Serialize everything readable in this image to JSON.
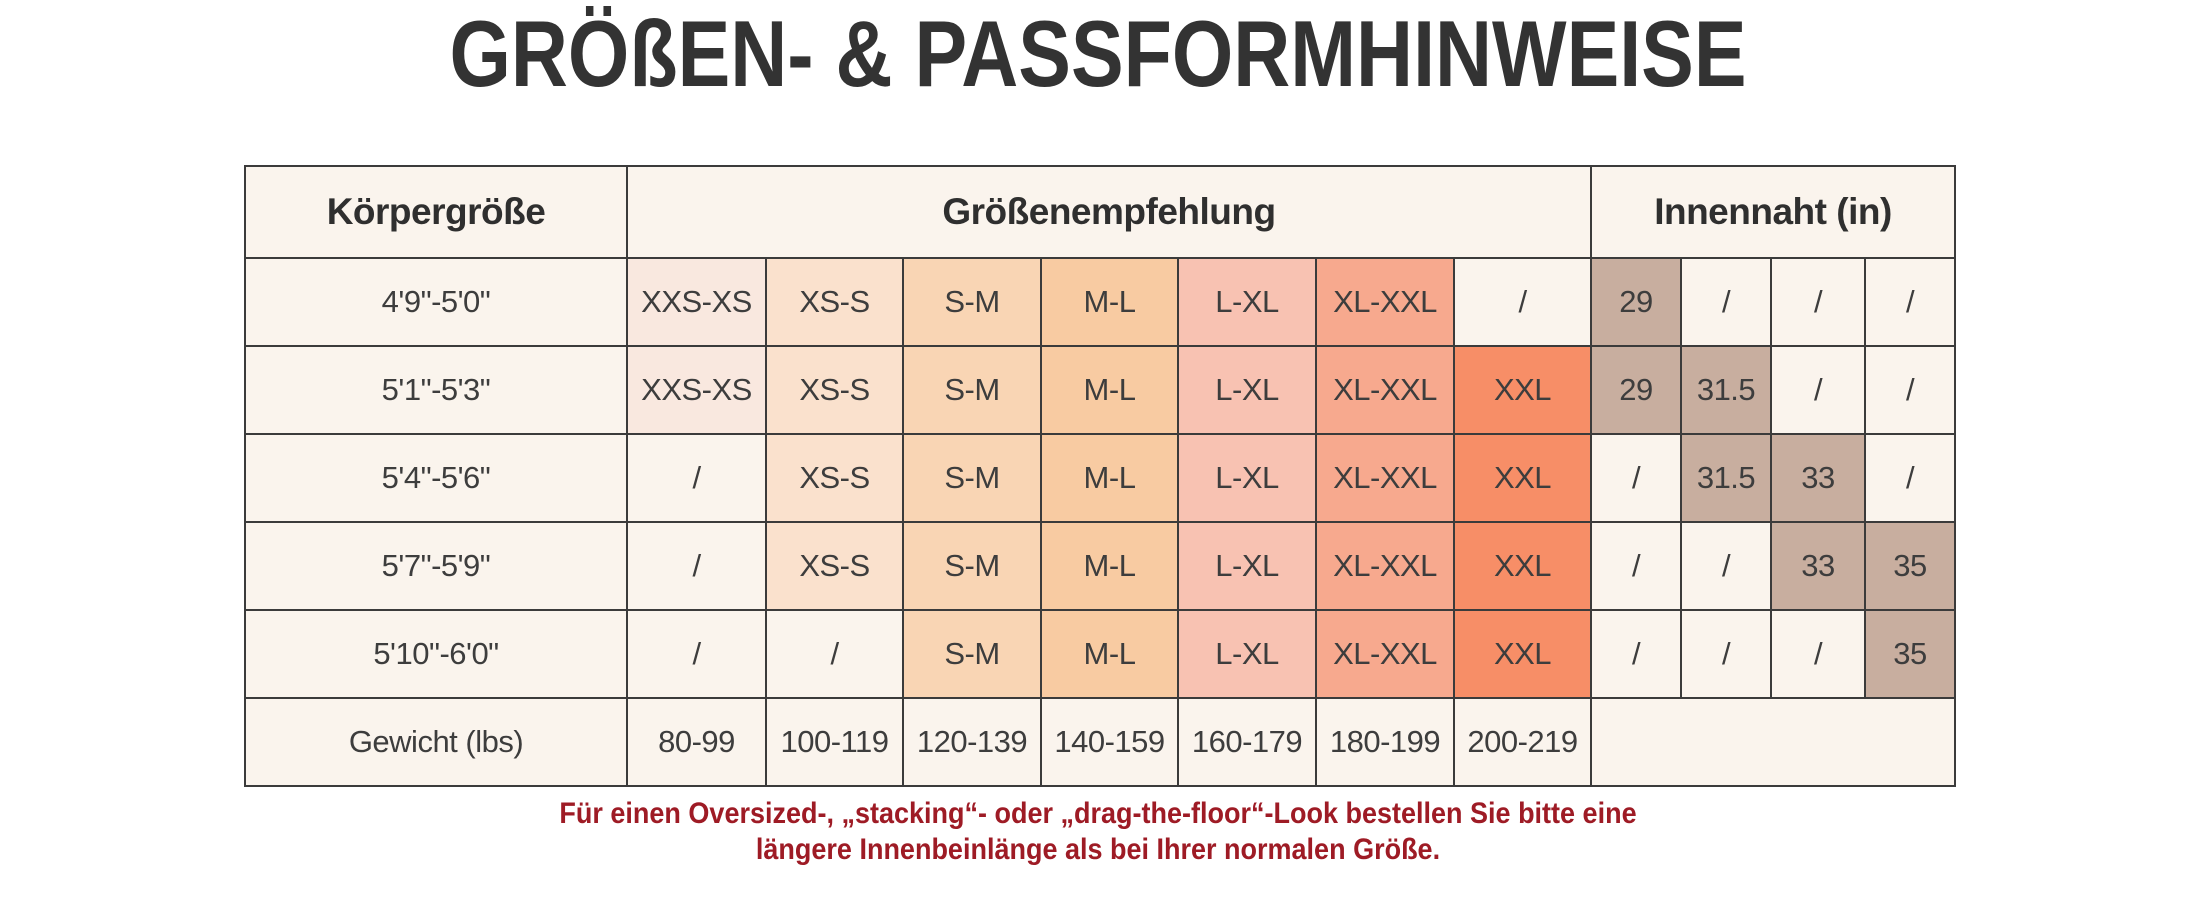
{
  "page": {
    "title": "GRÖßEN- & PASSFORMHINWEISE"
  },
  "table": {
    "headers": {
      "col1": "Körpergröße",
      "col2": "Größenempfehlung",
      "col3": "Innennaht (in)"
    },
    "rows": [
      {
        "height": "4'9\"-5'0\"",
        "sizes": [
          "XXS-XS",
          "XS-S",
          "S-M",
          "M-L",
          "L-XL",
          "XL-XXL",
          "/"
        ],
        "inseam": [
          "29",
          "/",
          "/",
          "/"
        ]
      },
      {
        "height": "5'1\"-5'3\"",
        "sizes": [
          "XXS-XS",
          "XS-S",
          "S-M",
          "M-L",
          "L-XL",
          "XL-XXL",
          "XXL"
        ],
        "inseam": [
          "29",
          "31.5",
          "/",
          "/"
        ]
      },
      {
        "height": "5'4\"-5'6\"",
        "sizes": [
          "/",
          "XS-S",
          "S-M",
          "M-L",
          "L-XL",
          "XL-XXL",
          "XXL"
        ],
        "inseam": [
          "/",
          "31.5",
          "33",
          "/"
        ]
      },
      {
        "height": "5'7\"-5'9\"",
        "sizes": [
          "/",
          "XS-S",
          "S-M",
          "M-L",
          "L-XL",
          "XL-XXL",
          "XXL"
        ],
        "inseam": [
          "/",
          "/",
          "33",
          "35"
        ]
      },
      {
        "height": "5'10\"-6'0\"",
        "sizes": [
          "/",
          "/",
          "S-M",
          "M-L",
          "L-XL",
          "XL-XXL",
          "XXL"
        ],
        "inseam": [
          "/",
          "/",
          "/",
          "35"
        ]
      }
    ],
    "weight_row": {
      "label": "Gewicht (lbs)",
      "values": [
        "80-99",
        "100-119",
        "120-139",
        "140-159",
        "160-179",
        "180-199",
        "200-219"
      ]
    }
  },
  "footer": {
    "line1": "Für einen Oversized-, „stacking“- oder „drag-the-floor“-Look bestellen Sie bitte eine",
    "line2": "längere Innenbeinlänge als bei Ihrer normalen Größe."
  },
  "colors": {
    "title_text": "#333333",
    "cell_text": "#3d3d3d",
    "cell_cream": "#faf4ed",
    "border": "#3b3b3b",
    "size_columns": [
      "#f9e8df",
      "#fae1cd",
      "#f9d5b4",
      "#f8cba2",
      "#f8c2b2",
      "#f7a98e",
      "#f78e67"
    ],
    "inseam_filled": "#c8ae9f",
    "footer_red": "#9e1b25"
  }
}
